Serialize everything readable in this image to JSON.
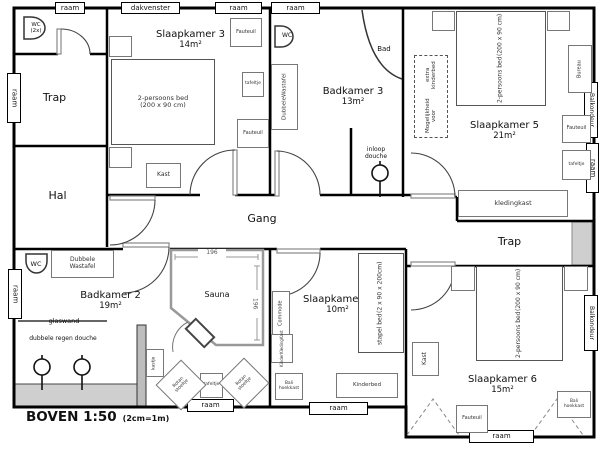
{
  "plan": {
    "title": "BOVEN 1:50",
    "scale_note": "(2cm=1m)",
    "rooms": {
      "slaapkamer3": {
        "name": "Slaapkamer 3",
        "area": "14m²"
      },
      "badkamer3": {
        "name": "Badkamer 3",
        "area": "13m²"
      },
      "slaapkamer5": {
        "name": "Slaapkamer 5",
        "area": "21m²"
      },
      "slaapkamer4": {
        "name": "Slaapkamer 4",
        "area": "10m²"
      },
      "slaapkamer6": {
        "name": "Slaapkamer 6",
        "area": "15m²"
      },
      "badkamer2": {
        "name": "Badkamer 2",
        "area": "19m²"
      },
      "trap": "Trap",
      "hal": "Hal",
      "gang": "Gang",
      "sauna": "Sauna"
    },
    "openings": {
      "raam": "raam",
      "dakvenster": "dakvenster",
      "balkondeur": "Balkondeur"
    },
    "fixtures": {
      "wc": "WC",
      "wc_count": "(2x)",
      "bad": "Bad",
      "inloop_line1": "inloop",
      "inloop_line2": "douche",
      "dubbele_regen_douche": "dubbele regen douche",
      "glaswand": "glaswand",
      "wastafel_line1": "Dubbele",
      "wastafel_line2": "Wastafel"
    },
    "furniture": {
      "bed_name": "2-persoons bed",
      "bed_size": "(200 x 90 cm)",
      "fauteuil": "Fauteuil",
      "tafeltje": "tafeltje",
      "kast": "Kast",
      "kastje": "kastje",
      "kledingkast": "kledingkast",
      "extra_kinderbed_line1": "Mogelijkheid voor",
      "extra_kinderbed_line2": "extra kinderbed",
      "bureau": "Bureau",
      "stapelbed_name": "stapel bed",
      "stapelbed_size": "(2 x 90 x 200cm)",
      "commode": "Commode",
      "kkk_line1": "Kinder",
      "kkk_line2": "Kleding",
      "kkk_line3": "Kast",
      "bali_line1": "Bali",
      "bali_line2": "hoekkast",
      "kinderbed": "Kinderbed",
      "rotan_line1": "Rotan",
      "rotan_line2": "stoeltje"
    },
    "dimensions": {
      "sauna_width": "196",
      "sauna_depth": "196"
    }
  }
}
